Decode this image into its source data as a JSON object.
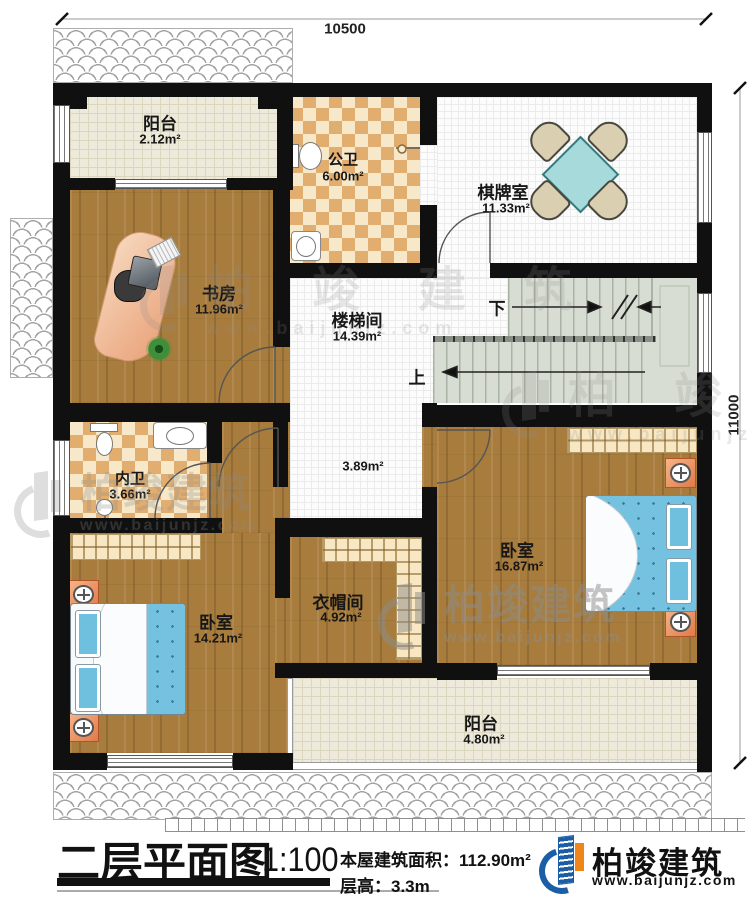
{
  "plan": {
    "dim_top": "10500",
    "dim_right": "11000",
    "stair_up": "上",
    "stair_down": "下",
    "hall_area": "3.89m²",
    "rooms": {
      "balcony_top": {
        "name": "阳台",
        "area": "2.12m²"
      },
      "public_bath": {
        "name": "公卫",
        "area": "6.00m²"
      },
      "chess_room": {
        "name": "棋牌室",
        "area": "11.33m²"
      },
      "study": {
        "name": "书房",
        "area": "11.96m²"
      },
      "stairwell": {
        "name": "楼梯间",
        "area": "14.39m²"
      },
      "private_bath": {
        "name": "内卫",
        "area": "3.66m²"
      },
      "bedroom_right": {
        "name": "卧室",
        "area": "16.87m²"
      },
      "bedroom_left": {
        "name": "卧室",
        "area": "14.21m²"
      },
      "cloakroom": {
        "name": "衣帽间",
        "area": "4.92m²"
      },
      "balcony_bottom": {
        "name": "阳台",
        "area": "4.80m²"
      }
    }
  },
  "title_block": {
    "title": "二层平面图",
    "scale": "1:100",
    "building_area": "本屋建筑面积：112.90m²",
    "floor_height": "层高：3.3m"
  },
  "brand": {
    "name": "柏竣建筑",
    "url": "www.baijunjz.com"
  },
  "watermark": {
    "name": "柏竣建筑",
    "url": "www.baijunjz.com"
  },
  "colors": {
    "wall": "#101010",
    "wood_floor": "#a87c3c",
    "bath_tile": "#e2ae70",
    "bed": "#74c2df",
    "game_table": "#a6dadb",
    "brand_blue": "#1b5ea6",
    "brand_orange": "#f08519"
  }
}
